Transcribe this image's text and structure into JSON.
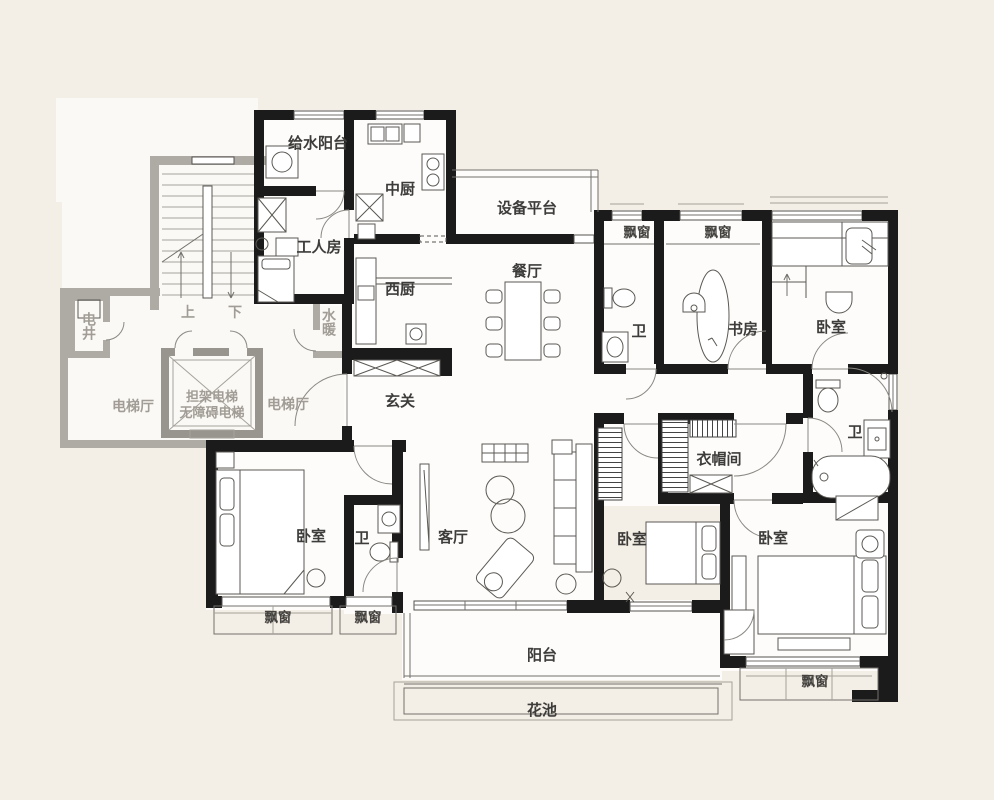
{
  "document": {
    "type": "apartment-floor-plan",
    "colors": {
      "background": "#f4efe6",
      "unit_wall": "#1b1b1b",
      "common_wall": "#aeaaa4",
      "floor": "#fdfcfa",
      "label_dark": "#3d3c3a",
      "label_gray": "#a19d96"
    }
  },
  "labels": {
    "water_balcony": "给水阳台",
    "chinese_kitchen": "中厨",
    "equipment_platform": "设备平台",
    "worker_room": "工人房",
    "western_kitchen": "西厨",
    "dining_room": "餐厅",
    "bay_window": "飘窗",
    "bath": "卫",
    "study": "书房",
    "bedroom": "卧室",
    "cloakroom": "衣帽间",
    "foyer": "玄关",
    "electrical_shaft": "电井",
    "up": "上",
    "down": "下",
    "water_heating": "水暖",
    "elevator_hall": "电梯厅",
    "stretcher_elevator": "担架电梯",
    "accessible_elevator": "无障碍电梯",
    "living_room": "客厅",
    "balcony": "阳台",
    "flower_bed": "花池"
  }
}
